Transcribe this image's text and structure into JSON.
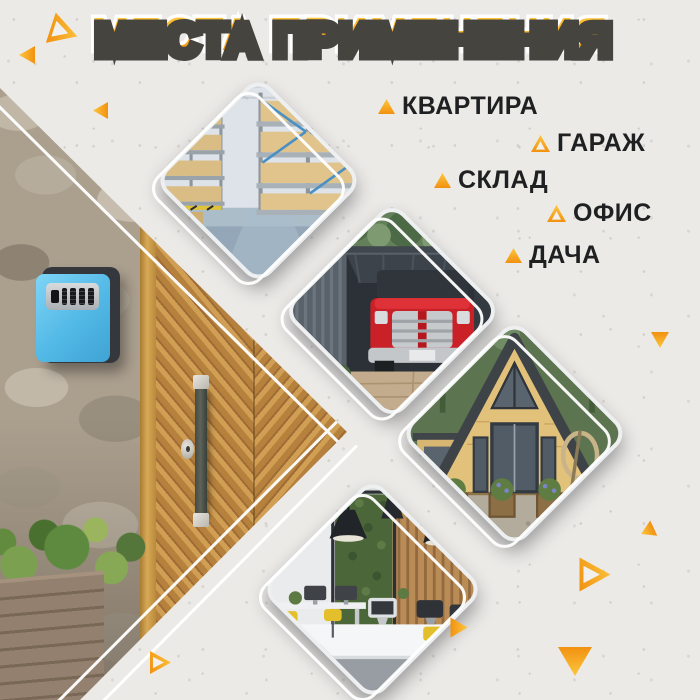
{
  "title": "МЕСТА ПРИМЕНЕНИЯ",
  "colors": {
    "accent_orange": "#f7a01d",
    "text_black": "#1f2022",
    "background_gray": "#eceae7",
    "key_safe_blue": "#5bc0ea"
  },
  "applications": [
    {
      "label": "КВАРТИРА",
      "bullet": "solid"
    },
    {
      "label": "ГАРАЖ",
      "bullet": "outline"
    },
    {
      "label": "СКЛАД",
      "bullet": "solid"
    },
    {
      "label": "ОФИС",
      "bullet": "outline"
    },
    {
      "label": "ДАЧА",
      "bullet": "solid"
    }
  ],
  "photos": [
    {
      "name": "warehouse"
    },
    {
      "name": "garage-with-red-pickup"
    },
    {
      "name": "a-frame-country-house"
    },
    {
      "name": "office-workspace"
    }
  ],
  "hero": {
    "name": "blue-key-safe-on-stone-wall-next-to-wooden-door"
  }
}
